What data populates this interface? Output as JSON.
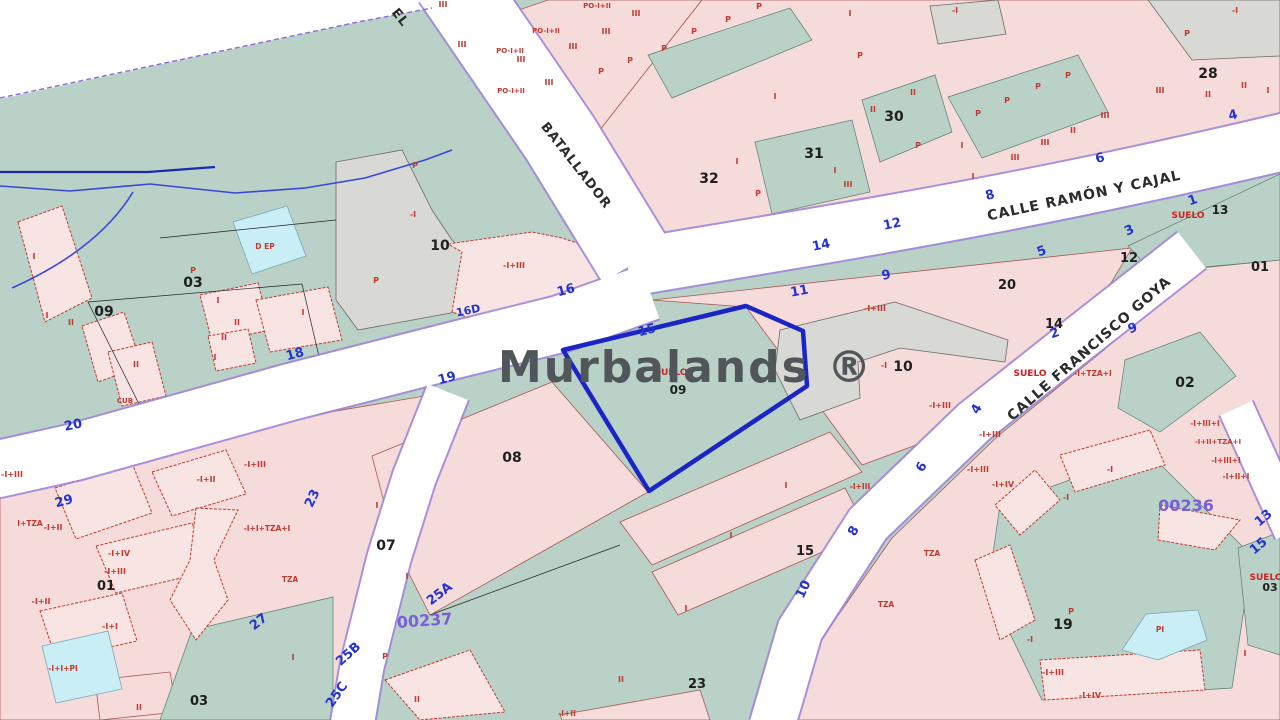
{
  "app": {
    "watermark": "Murbalands ®",
    "watermark_color": "#50565a"
  },
  "colors": {
    "green_zone": "#b9d1c6",
    "pink_block": "#f6dbdb",
    "building": "#f9e4e4",
    "gray_parcel": "#d8d8d4",
    "pool_cyan": "#c9eef6",
    "street_white": "#ffffff",
    "street_casing": "#9d82d8",
    "selected_parcel_blue": "#1b24c4",
    "house_number_blue": "#2433cc",
    "red_label": "#c03a30",
    "district_code_purple": "#7b5fd6",
    "river_blue": "#3847d6",
    "boundary_purple": "#8f6bd6"
  },
  "selected_parcel": {
    "code": "09",
    "soil_label": "SUELO"
  },
  "streets": [
    {
      "t": "EL",
      "x": 397,
      "y": 20,
      "r": 52,
      "s": 13
    },
    {
      "t": "BATALLADOR",
      "x": 573,
      "y": 168,
      "r": 52,
      "s": 13
    },
    {
      "t": "CALLE RAMÓN Y CAJAL",
      "x": 1085,
      "y": 200,
      "r": -12,
      "s": 14
    },
    {
      "t": "CALLE FRANCISCO GOYA",
      "x": 1092,
      "y": 352,
      "r": -41,
      "s": 14
    }
  ],
  "district_codes": [
    {
      "t": "00237",
      "x": 425,
      "y": 626,
      "r": -4,
      "s": 16
    },
    {
      "t": "00236",
      "x": 1186,
      "y": 511,
      "r": 0,
      "s": 16
    }
  ],
  "parcel_numbers": [
    {
      "t": "09",
      "x": 104,
      "y": 316,
      "s": 14
    },
    {
      "t": "03",
      "x": 193,
      "y": 287,
      "s": 14
    },
    {
      "t": "10",
      "x": 440,
      "y": 250,
      "s": 14
    },
    {
      "t": "10",
      "x": 903,
      "y": 371,
      "s": 14
    },
    {
      "t": "31",
      "x": 814,
      "y": 158,
      "s": 14
    },
    {
      "t": "32",
      "x": 709,
      "y": 183,
      "s": 14
    },
    {
      "t": "30",
      "x": 894,
      "y": 121,
      "s": 14
    },
    {
      "t": "28",
      "x": 1208,
      "y": 78,
      "s": 14
    },
    {
      "t": "14",
      "x": 1054,
      "y": 328,
      "s": 13
    },
    {
      "t": "12",
      "x": 1129,
      "y": 262,
      "s": 13
    },
    {
      "t": "20",
      "x": 1007,
      "y": 289,
      "s": 13
    },
    {
      "t": "01",
      "x": 1260,
      "y": 271,
      "s": 13
    },
    {
      "t": "02",
      "x": 1185,
      "y": 387,
      "s": 14
    },
    {
      "t": "13",
      "x": 1220,
      "y": 214,
      "s": 12
    },
    {
      "t": "08",
      "x": 512,
      "y": 462,
      "s": 14
    },
    {
      "t": "07",
      "x": 386,
      "y": 550,
      "s": 14
    },
    {
      "t": "15",
      "x": 805,
      "y": 555,
      "s": 13
    },
    {
      "t": "23",
      "x": 697,
      "y": 688,
      "s": 13
    },
    {
      "t": "03",
      "x": 199,
      "y": 705,
      "s": 13
    },
    {
      "t": "01",
      "x": 106,
      "y": 590,
      "s": 13
    },
    {
      "t": "19",
      "x": 1063,
      "y": 629,
      "s": 14
    },
    {
      "t": "09",
      "x": 678,
      "y": 394,
      "s": 12
    },
    {
      "t": "03",
      "x": 1270,
      "y": 591,
      "s": 11
    }
  ],
  "house_numbers": [
    {
      "t": "20",
      "x": 74,
      "y": 429,
      "r": -12
    },
    {
      "t": "18",
      "x": 296,
      "y": 358,
      "r": -15
    },
    {
      "t": "16D",
      "x": 469,
      "y": 314,
      "r": -12,
      "s": 11
    },
    {
      "t": "16",
      "x": 567,
      "y": 294,
      "r": -15
    },
    {
      "t": "19",
      "x": 448,
      "y": 382,
      "r": -15
    },
    {
      "t": "15",
      "x": 648,
      "y": 334,
      "r": -15
    },
    {
      "t": "11",
      "x": 800,
      "y": 295,
      "r": -10
    },
    {
      "t": "9",
      "x": 887,
      "y": 279,
      "r": -12
    },
    {
      "t": "12",
      "x": 893,
      "y": 228,
      "r": -12
    },
    {
      "t": "14",
      "x": 822,
      "y": 249,
      "r": -12
    },
    {
      "t": "8",
      "x": 991,
      "y": 199,
      "r": -15
    },
    {
      "t": "6",
      "x": 1101,
      "y": 162,
      "r": -15
    },
    {
      "t": "4",
      "x": 1234,
      "y": 119,
      "r": -15
    },
    {
      "t": "3",
      "x": 1131,
      "y": 234,
      "r": -25
    },
    {
      "t": "5",
      "x": 1043,
      "y": 255,
      "r": -20
    },
    {
      "t": "1",
      "x": 1194,
      "y": 204,
      "r": -20
    },
    {
      "t": "2",
      "x": 1056,
      "y": 337,
      "r": -20
    },
    {
      "t": "9",
      "x": 1134,
      "y": 332,
      "r": -20
    },
    {
      "t": "4",
      "x": 980,
      "y": 411,
      "r": -60
    },
    {
      "t": "6",
      "x": 925,
      "y": 469,
      "r": -60
    },
    {
      "t": "8",
      "x": 857,
      "y": 533,
      "r": -60
    },
    {
      "t": "10",
      "x": 807,
      "y": 591,
      "r": -65
    },
    {
      "t": "13",
      "x": 1266,
      "y": 521,
      "r": -40
    },
    {
      "t": "15",
      "x": 1261,
      "y": 549,
      "r": -40
    },
    {
      "t": "23",
      "x": 316,
      "y": 500,
      "r": -65
    },
    {
      "t": "25A",
      "x": 442,
      "y": 597,
      "r": -38
    },
    {
      "t": "25B",
      "x": 351,
      "y": 657,
      "r": -42
    },
    {
      "t": "25C",
      "x": 340,
      "y": 697,
      "r": -55
    },
    {
      "t": "27",
      "x": 261,
      "y": 625,
      "r": -38
    },
    {
      "t": "29",
      "x": 65,
      "y": 505,
      "r": -15
    }
  ],
  "suelo_labels": [
    {
      "t": "SUELO",
      "x": 1188,
      "y": 218,
      "s": 9
    },
    {
      "t": "SUELO",
      "x": 671,
      "y": 375,
      "s": 9
    },
    {
      "t": "SUELO",
      "x": 1266,
      "y": 580,
      "s": 9
    },
    {
      "t": "SUELO",
      "x": 1030,
      "y": 376,
      "s": 9
    }
  ],
  "building_labels": [
    {
      "t": "III",
      "x": 443,
      "y": 7
    },
    {
      "t": "III",
      "x": 462,
      "y": 47
    },
    {
      "t": "III",
      "x": 521,
      "y": 62
    },
    {
      "t": "III",
      "x": 549,
      "y": 85
    },
    {
      "t": "III",
      "x": 573,
      "y": 49
    },
    {
      "t": "III",
      "x": 606,
      "y": 34
    },
    {
      "t": "III",
      "x": 636,
      "y": 16
    },
    {
      "t": "PO-I+II",
      "x": 510,
      "y": 53,
      "s": 7
    },
    {
      "t": "PO-I+II",
      "x": 546,
      "y": 33,
      "s": 7
    },
    {
      "t": "PO-I+II",
      "x": 597,
      "y": 8,
      "s": 7
    },
    {
      "t": "PO-I+II",
      "x": 511,
      "y": 93,
      "s": 7
    },
    {
      "t": "P",
      "x": 601,
      "y": 74
    },
    {
      "t": "P",
      "x": 630,
      "y": 63
    },
    {
      "t": "P",
      "x": 664,
      "y": 51
    },
    {
      "t": "P",
      "x": 694,
      "y": 34
    },
    {
      "t": "P",
      "x": 728,
      "y": 22
    },
    {
      "t": "P",
      "x": 759,
      "y": 9
    },
    {
      "t": "P",
      "x": 860,
      "y": 58
    },
    {
      "t": "P",
      "x": 918,
      "y": 148
    },
    {
      "t": "P",
      "x": 758,
      "y": 196
    },
    {
      "t": "P",
      "x": 978,
      "y": 116
    },
    {
      "t": "P",
      "x": 1007,
      "y": 103
    },
    {
      "t": "P",
      "x": 1038,
      "y": 89
    },
    {
      "t": "P",
      "x": 1068,
      "y": 78
    },
    {
      "t": "P",
      "x": 1187,
      "y": 36
    },
    {
      "t": "P",
      "x": 376,
      "y": 283
    },
    {
      "t": "P",
      "x": 415,
      "y": 168
    },
    {
      "t": "P",
      "x": 193,
      "y": 273
    },
    {
      "t": "P",
      "x": 1071,
      "y": 614
    },
    {
      "t": "P",
      "x": 385,
      "y": 659
    },
    {
      "t": "I",
      "x": 850,
      "y": 16
    },
    {
      "t": "I",
      "x": 775,
      "y": 99
    },
    {
      "t": "I",
      "x": 737,
      "y": 164
    },
    {
      "t": "I",
      "x": 835,
      "y": 173
    },
    {
      "t": "I",
      "x": 962,
      "y": 148
    },
    {
      "t": "I",
      "x": 973,
      "y": 179
    },
    {
      "t": "II",
      "x": 873,
      "y": 112
    },
    {
      "t": "II",
      "x": 913,
      "y": 95
    },
    {
      "t": "III",
      "x": 848,
      "y": 187
    },
    {
      "t": "II",
      "x": 1208,
      "y": 97
    },
    {
      "t": "II",
      "x": 1244,
      "y": 88
    },
    {
      "t": "III",
      "x": 1160,
      "y": 93
    },
    {
      "t": "III",
      "x": 1105,
      "y": 118
    },
    {
      "t": "II",
      "x": 1073,
      "y": 133
    },
    {
      "t": "III",
      "x": 1045,
      "y": 145
    },
    {
      "t": "III",
      "x": 1015,
      "y": 160
    },
    {
      "t": "I",
      "x": 1268,
      "y": 93
    },
    {
      "t": "I",
      "x": 34,
      "y": 259
    },
    {
      "t": "I",
      "x": 47,
      "y": 318
    },
    {
      "t": "II",
      "x": 71,
      "y": 325
    },
    {
      "t": "I",
      "x": 218,
      "y": 303
    },
    {
      "t": "II",
      "x": 237,
      "y": 325
    },
    {
      "t": "II",
      "x": 224,
      "y": 340
    },
    {
      "t": "I",
      "x": 215,
      "y": 360
    },
    {
      "t": "I",
      "x": 303,
      "y": 315
    },
    {
      "t": "II",
      "x": 136,
      "y": 367
    },
    {
      "t": "CUB",
      "x": 125,
      "y": 403,
      "s": 7
    },
    {
      "t": "D EP",
      "x": 265,
      "y": 249,
      "s": 7.5
    },
    {
      "t": "-I",
      "x": 955,
      "y": 13
    },
    {
      "t": "-I",
      "x": 1235,
      "y": 13
    },
    {
      "t": "-I",
      "x": 413,
      "y": 217
    },
    {
      "t": "-I",
      "x": 884,
      "y": 368
    },
    {
      "t": "-I+III",
      "x": 514,
      "y": 268
    },
    {
      "t": "-I+III",
      "x": 875,
      "y": 311
    },
    {
      "t": "-I+III",
      "x": 940,
      "y": 408
    },
    {
      "t": "-I+TZA+I",
      "x": 1093,
      "y": 376,
      "s": 7.5
    },
    {
      "t": "I+TZA",
      "x": 30,
      "y": 526,
      "s": 7.5
    },
    {
      "t": "-I+I+TZA+I",
      "x": 267,
      "y": 531,
      "s": 7.5
    },
    {
      "t": "TZA",
      "x": 290,
      "y": 582,
      "s": 7.5
    },
    {
      "t": "-I+II",
      "x": 53,
      "y": 530
    },
    {
      "t": "-I+II",
      "x": 206,
      "y": 482
    },
    {
      "t": "-I+II",
      "x": 41,
      "y": 604
    },
    {
      "t": "-I+III",
      "x": 255,
      "y": 467
    },
    {
      "t": "-I+III",
      "x": 115,
      "y": 574
    },
    {
      "t": "-I+III",
      "x": 12,
      "y": 477
    },
    {
      "t": "-I+IV",
      "x": 119,
      "y": 556
    },
    {
      "t": "-I+I",
      "x": 110,
      "y": 629
    },
    {
      "t": "-I+I+PI",
      "x": 63,
      "y": 671,
      "s": 7.5
    },
    {
      "t": "I",
      "x": 377,
      "y": 508
    },
    {
      "t": "I",
      "x": 407,
      "y": 579
    },
    {
      "t": "I",
      "x": 293,
      "y": 660
    },
    {
      "t": "I",
      "x": 786,
      "y": 488
    },
    {
      "t": "I",
      "x": 731,
      "y": 538
    },
    {
      "t": "I",
      "x": 686,
      "y": 611
    },
    {
      "t": "II",
      "x": 621,
      "y": 682
    },
    {
      "t": "II",
      "x": 139,
      "y": 710
    },
    {
      "t": "II",
      "x": 417,
      "y": 702
    },
    {
      "t": "-I+III",
      "x": 990,
      "y": 437
    },
    {
      "t": "-I+III",
      "x": 978,
      "y": 472
    },
    {
      "t": "-I+IV",
      "x": 1003,
      "y": 487
    },
    {
      "t": "TZA",
      "x": 886,
      "y": 607,
      "s": 7.5
    },
    {
      "t": "TZA",
      "x": 932,
      "y": 556,
      "s": 7.5
    },
    {
      "t": "-I+III+I",
      "x": 1205,
      "y": 426,
      "s": 7.5
    },
    {
      "t": "-I+II+TZA+I",
      "x": 1218,
      "y": 444,
      "s": 7
    },
    {
      "t": "-I+III+I",
      "x": 1226,
      "y": 463,
      "s": 7.5
    },
    {
      "t": "-I+II+I",
      "x": 1236,
      "y": 479,
      "s": 7.5
    },
    {
      "t": "-I",
      "x": 1030,
      "y": 642
    },
    {
      "t": "-I",
      "x": 1110,
      "y": 472
    },
    {
      "t": "-I",
      "x": 1066,
      "y": 500
    },
    {
      "t": "-I+III",
      "x": 1053,
      "y": 675
    },
    {
      "t": "-I+IV",
      "x": 1090,
      "y": 698
    },
    {
      "t": "I",
      "x": 1245,
      "y": 656
    },
    {
      "t": "PI",
      "x": 1160,
      "y": 632,
      "s": 7.5
    },
    {
      "t": "-I+III",
      "x": 860,
      "y": 489,
      "s": 7.5
    },
    {
      "t": "-I+II",
      "x": 567,
      "y": 716,
      "s": 7.5
    }
  ]
}
